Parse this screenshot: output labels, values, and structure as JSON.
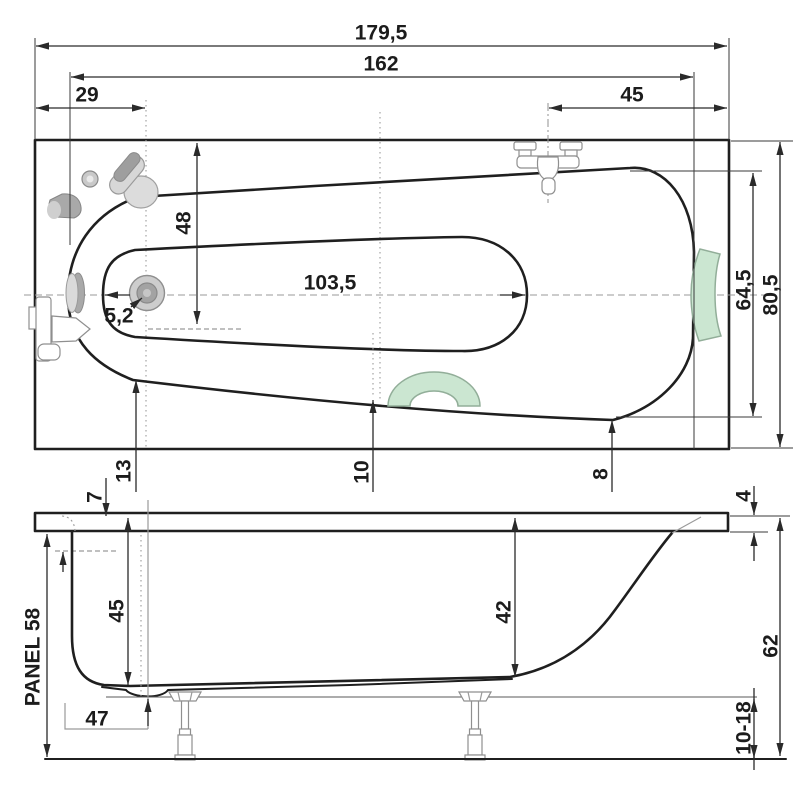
{
  "labels": {
    "overall_length": "179,5",
    "rim_length": "162",
    "drain_offset": "29",
    "faucet_offset": "45",
    "inner_half_width": "48",
    "basin_length": "103,5",
    "drain_diameter": "5,2",
    "inner_width": "64,5",
    "outer_width": "80,5",
    "clearance_foot": "13",
    "clearance_mid": "10",
    "clearance_head": "8",
    "rim_edge": "7",
    "rim_thickness": "4",
    "depth_foot": "45",
    "depth_head": "42",
    "panel": "PANEL 58",
    "sump_height": "47",
    "total_height": "62",
    "feet_adjust": "10-18"
  },
  "colors": {
    "line": "#1f1f1f",
    "dimension": "#2a2a2a",
    "fixture_gray": "#9b9b9b",
    "accent_green": "#cbe6d1",
    "green_stroke": "#92ae99"
  }
}
